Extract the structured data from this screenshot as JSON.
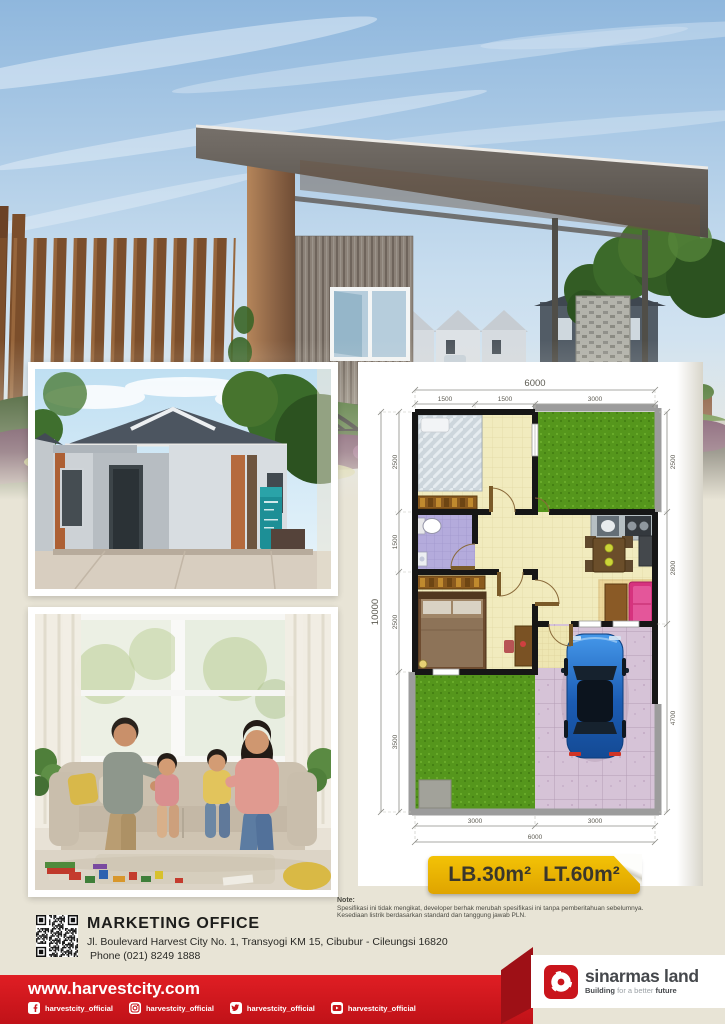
{
  "page": {
    "bg_color": "#e8e4d6",
    "accent_red": "#d2171d",
    "accent_yellow": "#eab600"
  },
  "floor_plan": {
    "dims": {
      "top_total": "6000",
      "top_segments": [
        "1500",
        "1500",
        "3000"
      ],
      "left_total": "10000",
      "left_segments": [
        "2500",
        "1500",
        "2500",
        "3500"
      ],
      "right_segments": [
        "2500",
        "2800",
        "4700"
      ],
      "bottom_segments": [
        "3000",
        "3000"
      ],
      "bottom_total": "6000"
    }
  },
  "banner": {
    "lb": "LB.30m²",
    "lt": "LT.60m²"
  },
  "note": {
    "title": "Note:",
    "line1": "Spesifikasi ini tidak mengikat, developer berhak merubah spesifikasi ini tanpa pemberitahuan sebelumnya.",
    "line2": "Kesediaan listrik berdasarkan standard dan tanggung jawab PLN."
  },
  "marketing_office": {
    "title": "MARKETING OFFICE",
    "address": "Jl. Boulevard Harvest City No. 1, Transyogi KM 15, Cibubur - Cileungsi 16820",
    "phone": "Phone (021) 8249 1888"
  },
  "footer": {
    "website": "www.harvestcity.com",
    "socials": [
      {
        "network": "facebook",
        "icon": "facebook-icon",
        "handle": "harvestcity_official"
      },
      {
        "network": "instagram",
        "icon": "instagram-icon",
        "handle": "harvestcity_official"
      },
      {
        "network": "twitter",
        "icon": "twitter-icon",
        "handle": "harvestcity_official"
      },
      {
        "network": "youtube",
        "icon": "youtube-icon",
        "handle": "harvestcity_official"
      }
    ]
  },
  "brand": {
    "name": "sinarmas land",
    "tagline": {
      "b1": "Building",
      "mid": "for a better",
      "b2": "future"
    }
  }
}
